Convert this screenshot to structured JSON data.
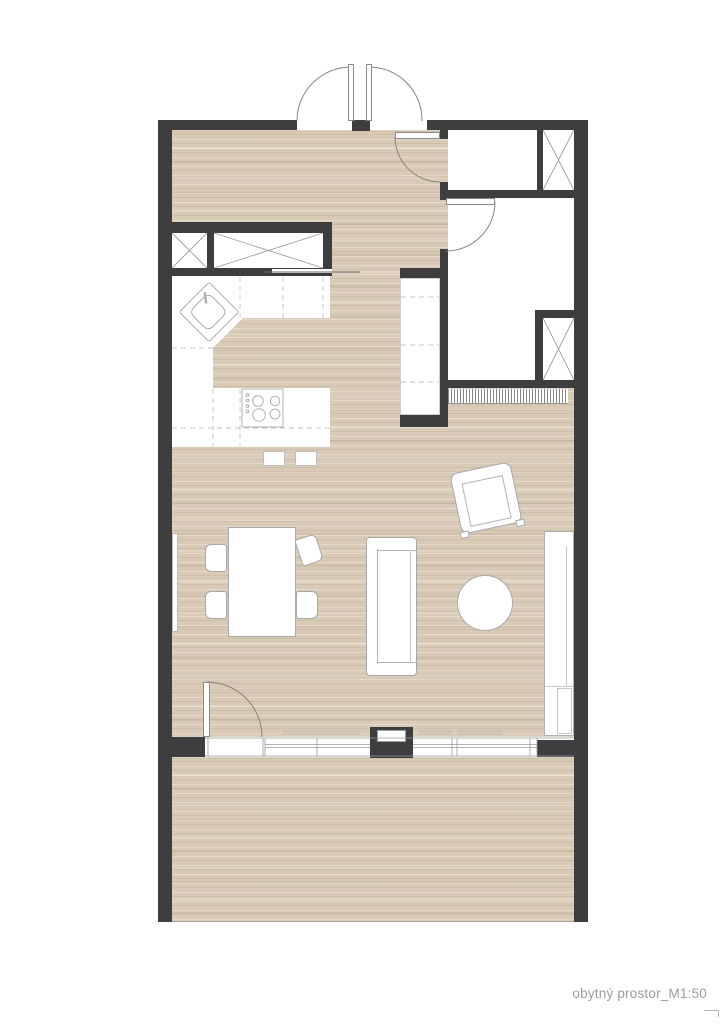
{
  "annotation": {
    "label": "obytný prostor_M1:50"
  },
  "colors": {
    "paper": "#ffffff",
    "wall": "#3e3e3e",
    "floor": "#d8cab6",
    "line": "#9f9f9f",
    "furniture-line": "#a8a8a8",
    "arc": "#8a8178",
    "text": "#9c9c9c"
  },
  "elements": [
    "entry-double-door",
    "hall",
    "toilet-room",
    "bathroom",
    "ventilation-shaft",
    "wardrobe-niche",
    "kitchen-counter",
    "kitchen-sink",
    "cooktop",
    "bar-stools",
    "dining-table",
    "dining-chairs",
    "sofa",
    "coffee-table",
    "armchair",
    "sideboard",
    "radiator",
    "radiator-grille",
    "window-wall",
    "balcony-door",
    "facade-pillar",
    "terrace"
  ]
}
